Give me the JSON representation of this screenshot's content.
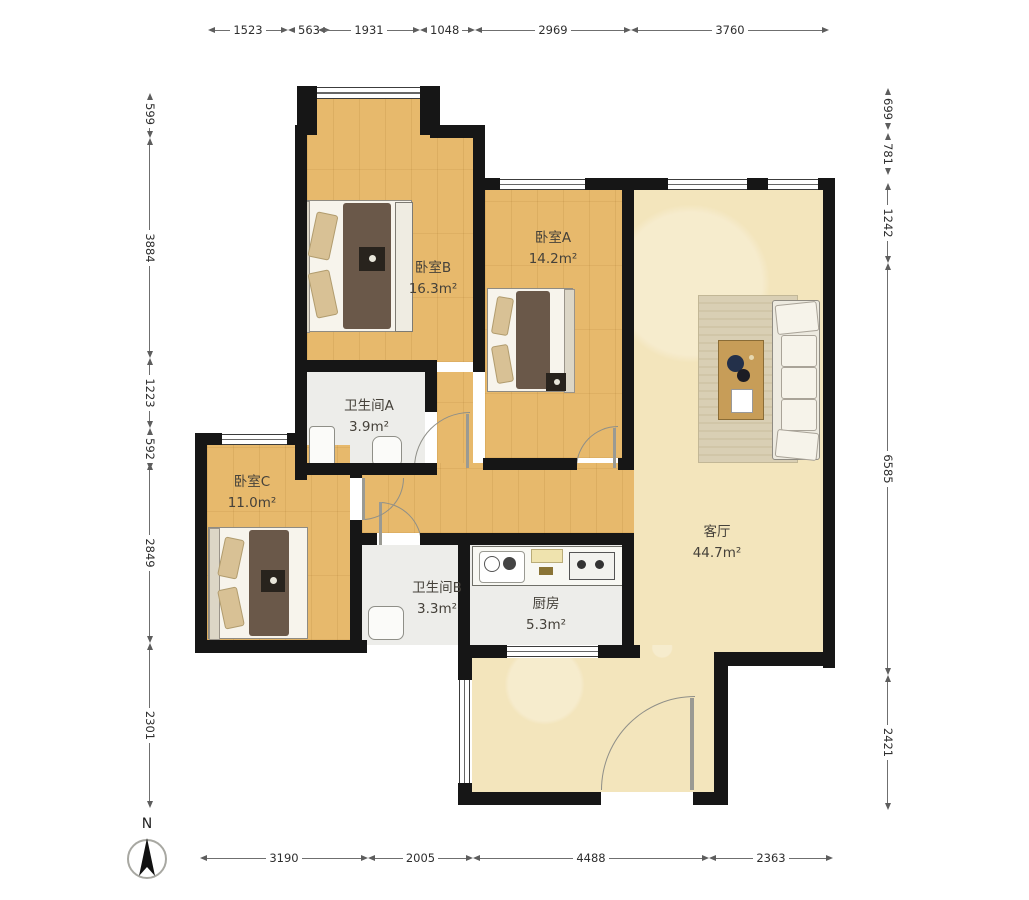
{
  "dims": {
    "top": [
      "1523",
      "563",
      "1931",
      "1048",
      "2969",
      "3760"
    ],
    "bottom": [
      "3190",
      "2005",
      "4488",
      "2363"
    ],
    "left": [
      "599",
      "3884",
      "1223",
      "592",
      "2849",
      "2301"
    ],
    "right": [
      "699",
      "781",
      "1242",
      "6585",
      "2421"
    ]
  },
  "rooms": {
    "bedroom_b": {
      "name": "卧室B",
      "area": "16.3m²"
    },
    "bedroom_a": {
      "name": "卧室A",
      "area": "14.2m²"
    },
    "bedroom_c": {
      "name": "卧室C",
      "area": "11.0m²"
    },
    "bathroom_a": {
      "name": "卫生间A",
      "area": "3.9m²"
    },
    "bathroom_b": {
      "name": "卫生间B",
      "area": "3.3m²"
    },
    "kitchen": {
      "name": "厨房",
      "area": "5.3m²"
    },
    "living_room": {
      "name": "客厅",
      "area": "44.7m²"
    }
  },
  "north": {
    "label": "N"
  },
  "colors": {
    "wall": "#161616",
    "wood_floor": "#e7b96c",
    "living_floor": "#f3e5bc",
    "tile_floor": "#ededea",
    "duvet": "#6a5849",
    "dimension_text": "#2e2e2e"
  }
}
